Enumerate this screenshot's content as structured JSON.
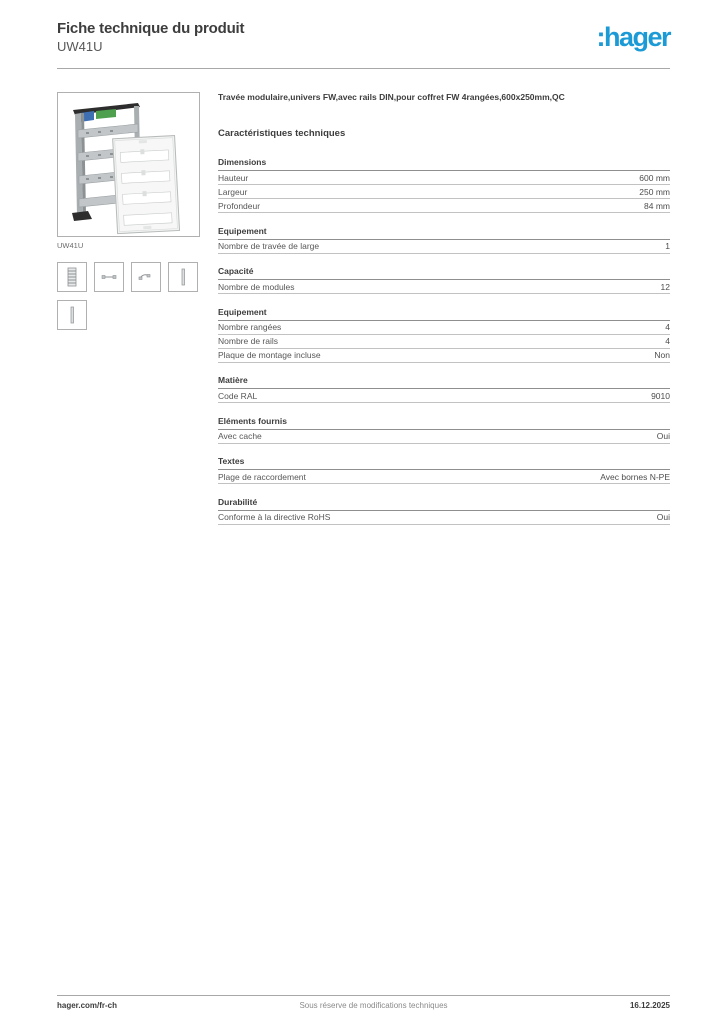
{
  "header": {
    "title": "Fiche technique du produit",
    "product_ref": "UW41U",
    "logo_text": ":hager",
    "brand_color": "#1b9ad6"
  },
  "sidebar": {
    "image_caption": "UW41U",
    "product_image": "modular-bay-with-din-rails-and-cover-photo",
    "thumbnails": [
      "rack-frame-thumb-icon",
      "rail-segment-thumb-icon",
      "rail-clip-thumb-icon",
      "cover-strip-thumb-icon",
      "cover-strip-2-thumb-icon"
    ]
  },
  "main": {
    "description": "Travée modulaire,univers FW,avec rails DIN,pour coffret FW 4rangées,600x250mm,QC",
    "section_title": "Caractéristiques techniques",
    "sections": [
      {
        "title": "Dimensions",
        "rows": [
          {
            "label": "Hauteur",
            "value": "600 mm"
          },
          {
            "label": "Largeur",
            "value": "250 mm"
          },
          {
            "label": "Profondeur",
            "value": "84 mm"
          }
        ]
      },
      {
        "title": "Equipement",
        "rows": [
          {
            "label": "Nombre de travée de large",
            "value": "1"
          }
        ]
      },
      {
        "title": "Capacité",
        "rows": [
          {
            "label": "Nombre de modules",
            "value": "12"
          }
        ]
      },
      {
        "title": "Equipement",
        "rows": [
          {
            "label": "Nombre rangées",
            "value": "4"
          },
          {
            "label": "Nombre de rails",
            "value": "4"
          },
          {
            "label": "Plaque de montage incluse",
            "value": "Non"
          }
        ]
      },
      {
        "title": "Matière",
        "rows": [
          {
            "label": "Code RAL",
            "value": "9010"
          }
        ]
      },
      {
        "title": "Eléments fournis",
        "rows": [
          {
            "label": "Avec cache",
            "value": "Oui"
          }
        ]
      },
      {
        "title": "Textes",
        "rows": [
          {
            "label": "Plage de raccordement",
            "value": "Avec bornes N-PE"
          }
        ]
      },
      {
        "title": "Durabilité",
        "rows": [
          {
            "label": "Conforme à la directive RoHS",
            "value": "Oui"
          }
        ]
      }
    ]
  },
  "footer": {
    "website": "hager.com/fr-ch",
    "notice": "Sous réserve de modifications techniques",
    "date": "16.12.2025"
  }
}
